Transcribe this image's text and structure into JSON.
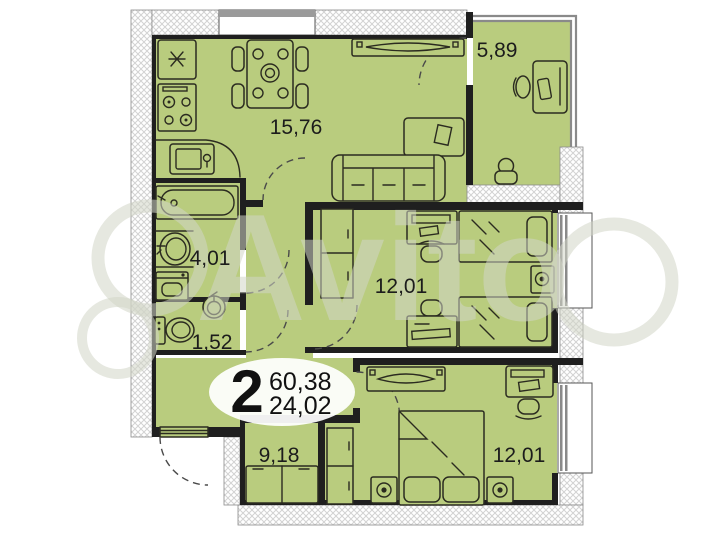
{
  "title": "2-room apartment floor plan",
  "badge": {
    "rooms_count": "2",
    "total_area": "60,38",
    "living_area": "24,02"
  },
  "rooms": {
    "kitchen_living": {
      "name": "kitchen-living-room",
      "area": "15,76"
    },
    "balcony": {
      "name": "balcony",
      "area": "5,89"
    },
    "bathroom": {
      "name": "bathroom",
      "area": "4,01"
    },
    "toilet": {
      "name": "toilet",
      "area": "1,52"
    },
    "bedroom_middle": {
      "name": "bedroom",
      "area": "12,01"
    },
    "room_small": {
      "name": "room",
      "area": "9,18"
    },
    "bedroom_bottom": {
      "name": "bedroom",
      "area": "12,01"
    }
  },
  "watermark": {
    "text": "Avito"
  },
  "furniture_icons": [
    "fridge-icon",
    "stove-icon",
    "kitchen-sink-icon",
    "dining-table-icon",
    "chair-icon",
    "tv-icon",
    "media-cabinet-icon",
    "sofa-icon",
    "desk-icon",
    "desk-chair-icon",
    "stool-icon",
    "bathtub-icon",
    "washbasin-icon",
    "washing-machine-icon",
    "toilet-icon",
    "corner-sink-icon",
    "wardrobe-icon",
    "single-bed-icon",
    "nightstand-lamp-icon",
    "double-bed-icon",
    "dresser-icon",
    "sofa-bed-icon",
    "entrance-door-icon",
    "window-icon",
    "door-swing-icon"
  ],
  "colors": {
    "room_fill": "#b9cc7e",
    "wall": "#1f1f1f",
    "line": "#2b2b20",
    "glazing": "#8a8a8a",
    "hatch": "#d2d2d2",
    "label_text": "#1c1c1c",
    "badge_bg": "#ffffff",
    "watermark": "rgba(210,213,198,0.55)"
  }
}
